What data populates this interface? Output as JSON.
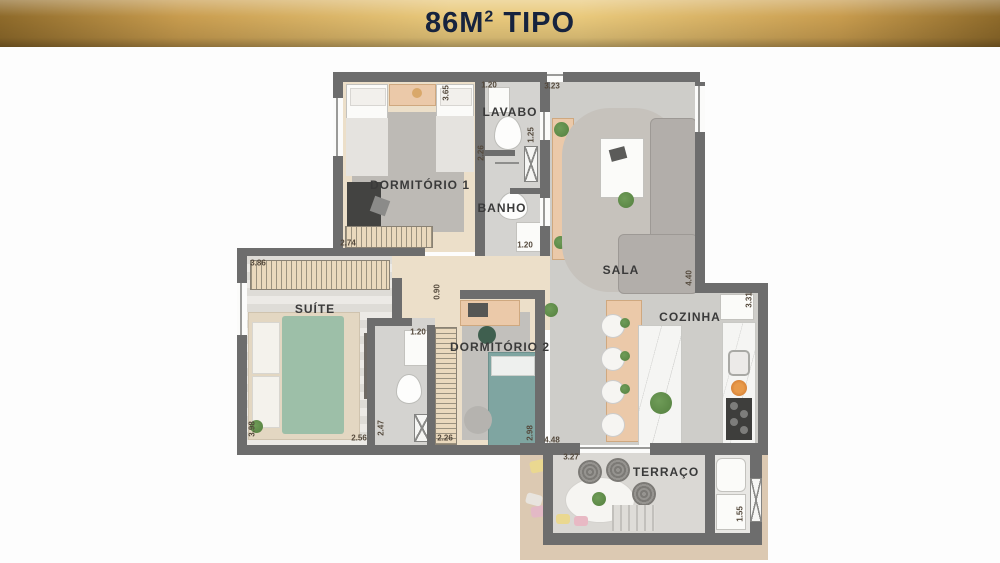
{
  "banner": {
    "area": "86M",
    "area_sup": "2",
    "type_label": "TIPO"
  },
  "rooms": {
    "dormitorio1": {
      "label": "DORMITÓRIO 1"
    },
    "lavabo": {
      "label": "LAVABO"
    },
    "banho": {
      "label": "BANHO"
    },
    "sala": {
      "label": "SALA"
    },
    "suite": {
      "label": "SUÍTE"
    },
    "dormitorio2": {
      "label": "DORMITÓRIO 2"
    },
    "cozinha": {
      "label": "COZINHA"
    },
    "terraco": {
      "label": "TERRAÇO"
    }
  },
  "dimensions": [
    {
      "value": "1.20",
      "loc": "lavabo-top"
    },
    {
      "value": "3.23",
      "loc": "sala-top"
    },
    {
      "value": "3.65",
      "loc": "dormitorio1-right"
    },
    {
      "value": "1.25",
      "loc": "lavabo-right"
    },
    {
      "value": "2.26",
      "loc": "banho-left"
    },
    {
      "value": "1.20",
      "loc": "banho-bottom"
    },
    {
      "value": "2.74",
      "loc": "dormitorio1-wardrobe"
    },
    {
      "value": "3.86",
      "loc": "suite-wardrobe"
    },
    {
      "value": "0.90",
      "loc": "hall"
    },
    {
      "value": "1.20",
      "loc": "suite-bath-top"
    },
    {
      "value": "3.98",
      "loc": "suite-left"
    },
    {
      "value": "2.56",
      "loc": "suite-bottom"
    },
    {
      "value": "2.47",
      "loc": "suite-bath-bottom"
    },
    {
      "value": "2.26",
      "loc": "closet-bottom"
    },
    {
      "value": "2.98",
      "loc": "dormitorio2-right"
    },
    {
      "value": "4.48",
      "loc": "dormitorio2-bottom"
    },
    {
      "value": "3.27",
      "loc": "terraco-top"
    },
    {
      "value": "4.40",
      "loc": "cozinha-left"
    },
    {
      "value": "3.31",
      "loc": "cozinha-right"
    },
    {
      "value": "1.55",
      "loc": "terraco-right"
    }
  ],
  "colors": {
    "banner-gold-dark": "#8e6a2a",
    "banner-gold-light": "#e9c97c",
    "banner-text": "#16233e",
    "wall": "#6d6d6d",
    "wood-floor": "#ecdfc9",
    "tile-floor": "#d4d3d0",
    "sala-floor": "#cecdc9",
    "suite-bed-green": "#9dbfa8",
    "dorm2-bed-teal": "#7fa5a1",
    "counter-wood": "#ebc9a9",
    "beige-patio": "#dcc9b2",
    "plant-green": "#54803f"
  }
}
